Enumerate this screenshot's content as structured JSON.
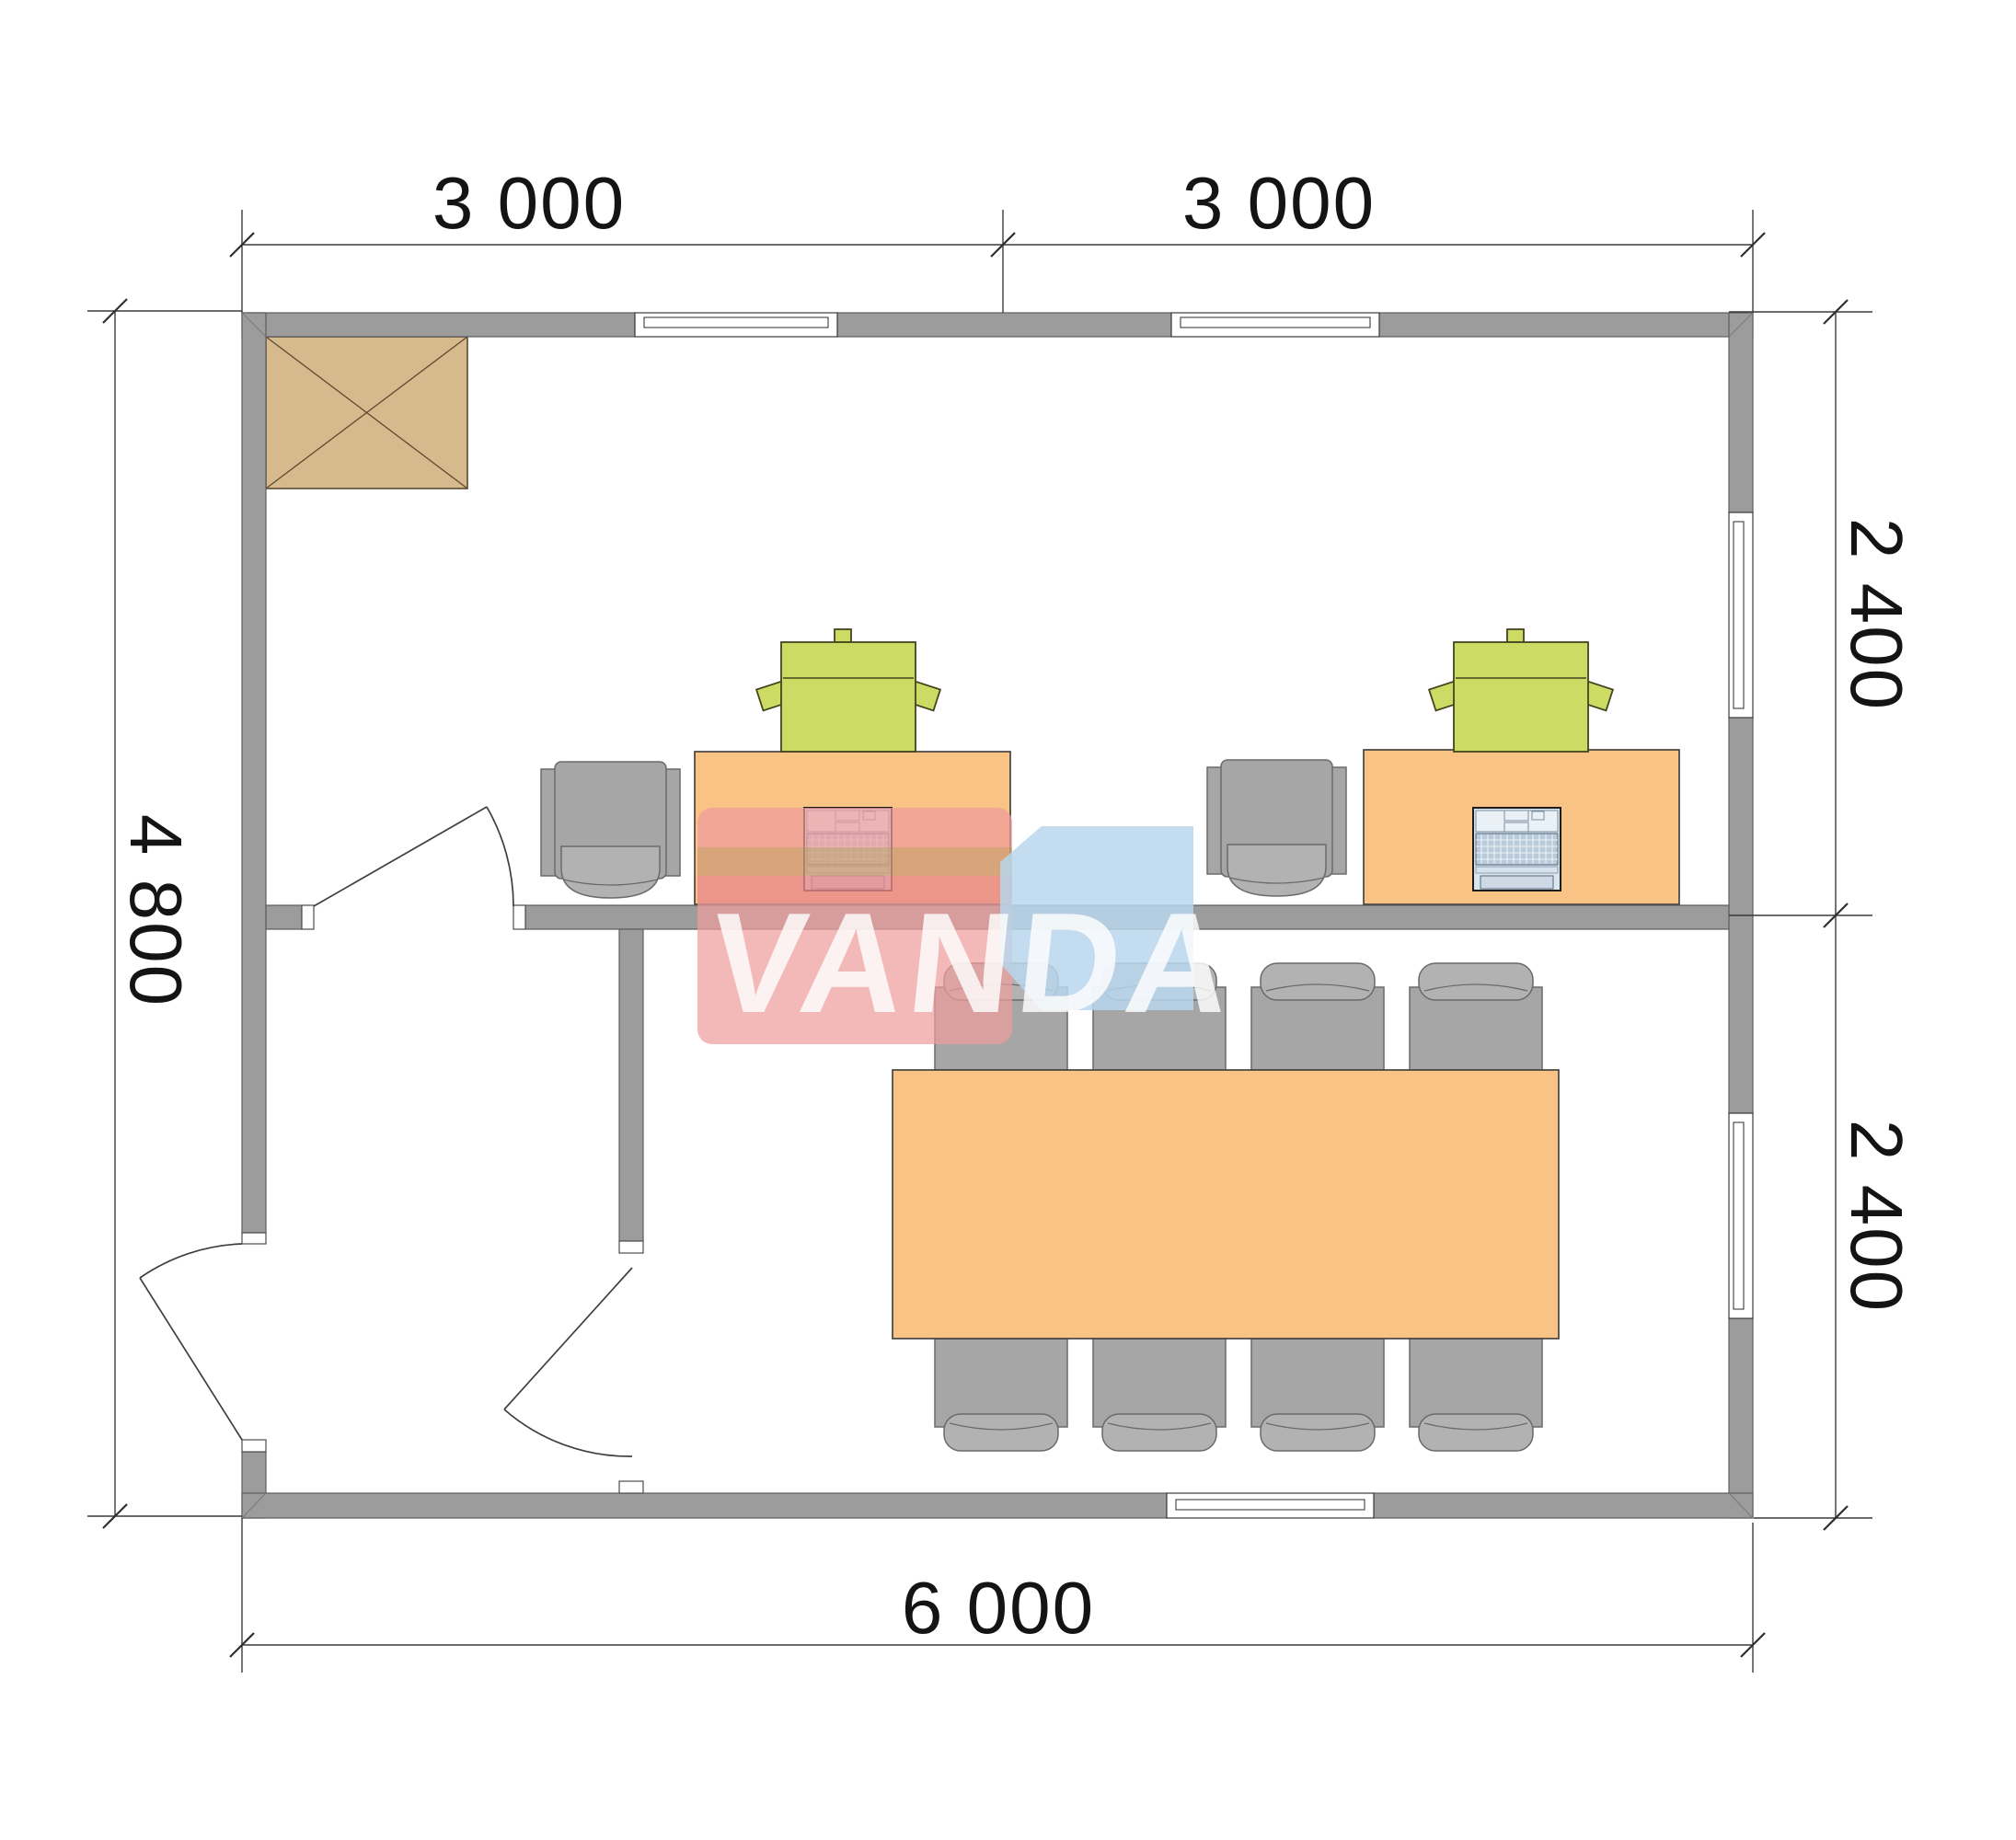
{
  "page": {
    "type": "architectural-floor-plan",
    "units": "mm"
  },
  "dimensions": {
    "top": [
      "3 000",
      "3 000"
    ],
    "right": [
      "2 400",
      "2 400"
    ],
    "left": "4 800",
    "bottom": "6 000"
  },
  "watermark": {
    "text": "VANDA",
    "pink": "#ee9d9d",
    "blue": "#b9d6ec"
  },
  "colors": {
    "wall_gray": "#9c9c9c",
    "furniture_orange": "#f9c386",
    "copier_green": "#ccdb64",
    "chair_gray": "#a6a6a6",
    "cabinet_tan": "#d7b98e",
    "laptop_blue": "#d9e5ef"
  }
}
